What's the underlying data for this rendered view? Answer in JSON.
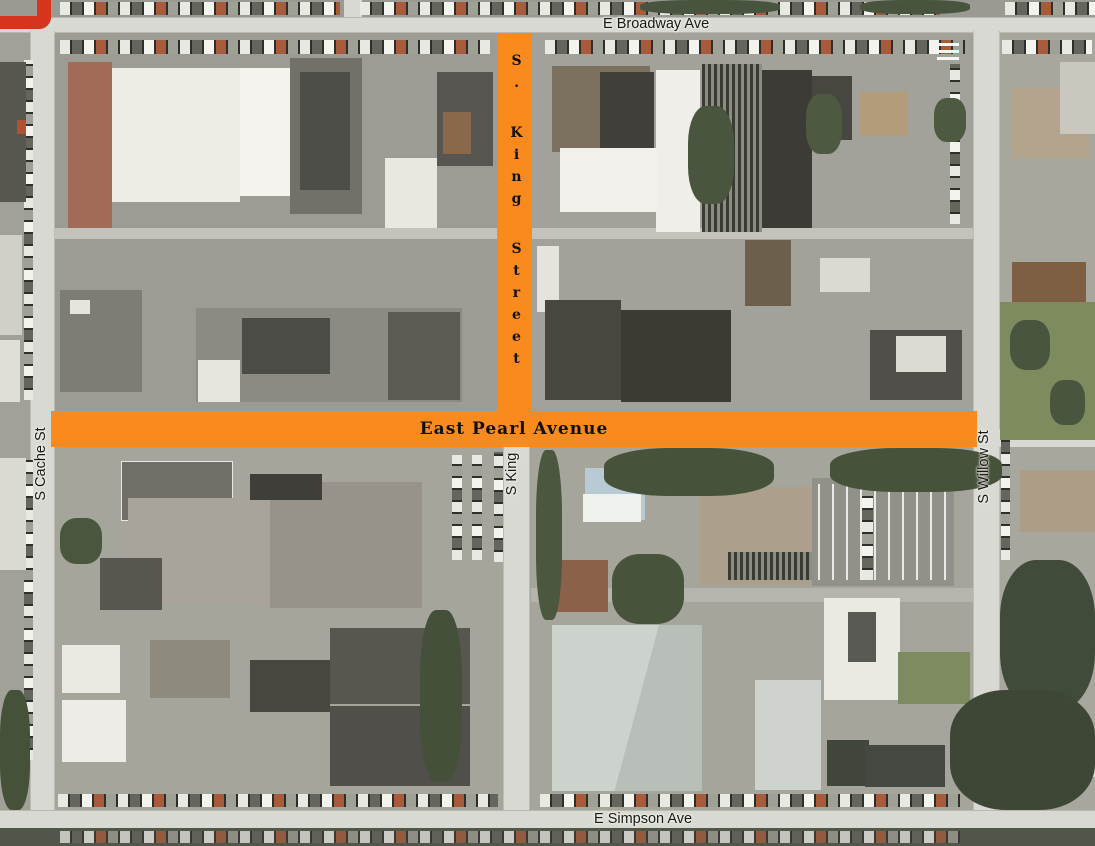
{
  "colors": {
    "highlight": "#F98A1E",
    "route": "#D7341D"
  },
  "streets": {
    "broadway": "E Broadway Ave",
    "cache": "S Cache St",
    "king_below": "S King",
    "willow": "S Willow St",
    "simpson": "E Simpson Ave",
    "king_highlight": "S. King Street",
    "pearl_highlight": "East Pearl Avenue"
  }
}
